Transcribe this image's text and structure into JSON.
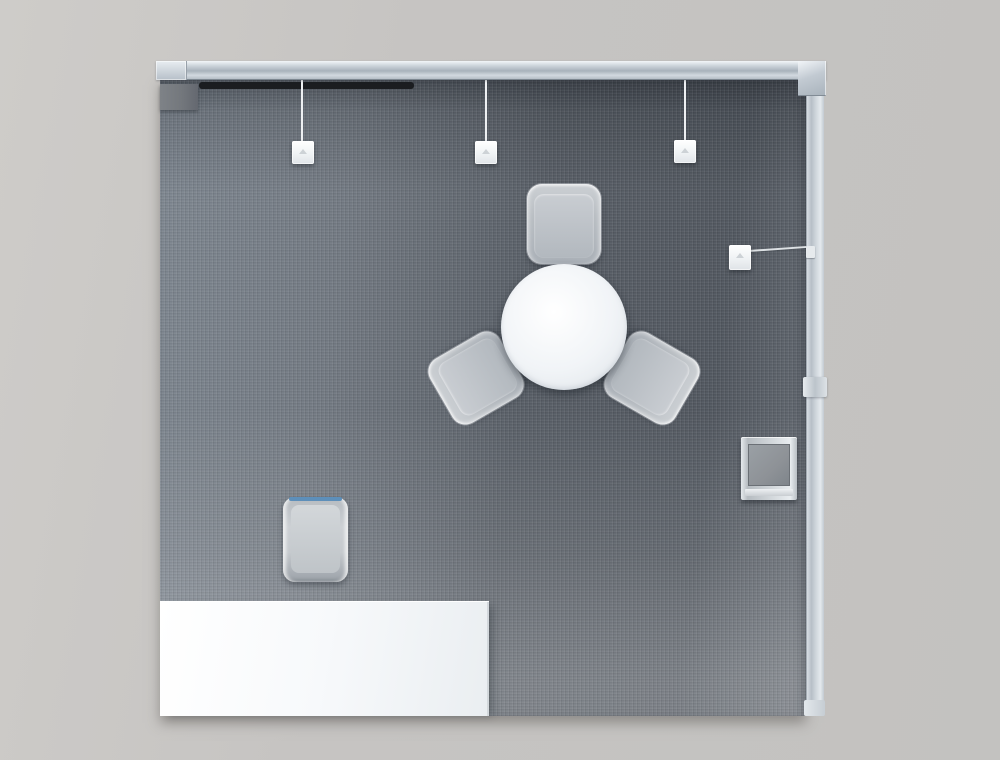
{
  "scene_title": "3D top-down render of an exhibition booth",
  "objects": {
    "carpet": "booth carpet floor",
    "beam": "overhead truss beam",
    "beam_left_cap": "truss left end cap",
    "beam_corner": "truss corner connector",
    "wall": "right side wall panel",
    "wall_joint": "wall panel joint",
    "wall_endcap": "wall panel end cap",
    "track": "ceiling-mounted black light track",
    "cabinet": "gray storage cabinet",
    "pendant_lights": [
      "pendant light left",
      "pendant light middle",
      "pendant light right"
    ],
    "arm_light": "wall-mounted arm spotlight",
    "kiosk": "monitor kiosk stand",
    "table": "round white meeting table",
    "chairs": [
      "guest chair north",
      "guest chair south-west",
      "guest chair south-east"
    ],
    "stool": "counter stool with blue back rail",
    "counter": "white reception counter"
  },
  "colors": {
    "background": "#c6c4c2",
    "background_light": "#ceccc9",
    "carpet_base": "#6d737b",
    "metal_light": "#f2f5f8",
    "metal_mid": "#a8b2bb",
    "furniture_white": "#f7f9fb",
    "chair_light": "#ccd0d4",
    "chair_mid": "#aab0b7",
    "track_black": "#1b1d20",
    "cabinet_gray": "#74787d",
    "screen_gray": "#8e9297",
    "accent_blue": "#5d8fba",
    "cord_white": "#eef0f2",
    "table_white": "#f1f4f7"
  }
}
